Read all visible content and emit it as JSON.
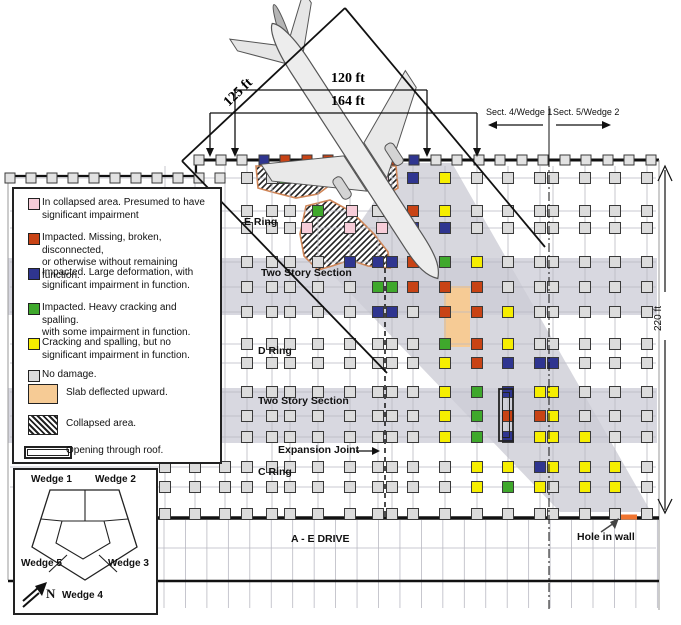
{
  "diagram": {
    "colors": {
      "P": "#f7cdd9",
      "R": "#c84315",
      "B": "#2f3590",
      "G": "#3fa82c",
      "Y": "#f6ee00",
      "gray": "#dcdcdc",
      "facade_gray": "#e2e2e2",
      "band": "#d8d8e0",
      "swath": "#cdcdd6",
      "slab": "#f6cb95",
      "hole_orange": "#f07430",
      "hatch_outline": "#cf8557",
      "grid_line": "#b9b9c2"
    },
    "facade": {
      "y": 160,
      "square_xs": [
        199,
        221,
        242,
        264,
        285,
        307,
        328,
        350,
        371,
        393,
        414,
        436,
        457,
        479,
        500,
        522,
        543,
        565,
        586,
        608,
        629,
        651
      ],
      "colored": {
        "3": "B",
        "4": "R",
        "5": "R",
        "6": "R",
        "9": "R",
        "10": "B"
      }
    },
    "left_wall": {
      "line_y": 176,
      "squares_y": 178,
      "xs": [
        10,
        31,
        52,
        73,
        94,
        115,
        136,
        157,
        178,
        199,
        220
      ]
    },
    "grid": {
      "cols": [
        247,
        272,
        290,
        318,
        350,
        378,
        392,
        413,
        445,
        477,
        508,
        540,
        553,
        585,
        615,
        647
      ],
      "left_cols": [
        165,
        195,
        225
      ],
      "rows": [
        178,
        211,
        228,
        262,
        287,
        312,
        344,
        363,
        392,
        416,
        437,
        467,
        487,
        514
      ]
    },
    "damage_squares": [
      {
        "x": 285,
        "y": 178,
        "c": "G"
      },
      {
        "x": 313,
        "y": 178,
        "c": "P"
      },
      {
        "x": 383,
        "y": 178,
        "c": "P"
      },
      {
        "x": 413,
        "y": 178,
        "c": "B"
      },
      {
        "x": 445,
        "y": 178,
        "c": "Y"
      },
      {
        "x": 318,
        "y": 211,
        "c": "G"
      },
      {
        "x": 352,
        "y": 211,
        "c": "P"
      },
      {
        "x": 413,
        "y": 211,
        "c": "R"
      },
      {
        "x": 445,
        "y": 211,
        "c": "Y"
      },
      {
        "x": 307,
        "y": 228,
        "c": "P"
      },
      {
        "x": 350,
        "y": 228,
        "c": "P"
      },
      {
        "x": 382,
        "y": 228,
        "c": "P"
      },
      {
        "x": 413,
        "y": 228,
        "c": "B"
      },
      {
        "x": 445,
        "y": 228,
        "c": "B"
      },
      {
        "x": 350,
        "y": 262,
        "c": "B"
      },
      {
        "x": 378,
        "y": 262,
        "c": "B"
      },
      {
        "x": 392,
        "y": 262,
        "c": "B"
      },
      {
        "x": 413,
        "y": 262,
        "c": "R"
      },
      {
        "x": 445,
        "y": 262,
        "c": "G"
      },
      {
        "x": 477,
        "y": 262,
        "c": "Y"
      },
      {
        "x": 378,
        "y": 287,
        "c": "G"
      },
      {
        "x": 392,
        "y": 287,
        "c": "G"
      },
      {
        "x": 413,
        "y": 287,
        "c": "R"
      },
      {
        "x": 445,
        "y": 287,
        "c": "R"
      },
      {
        "x": 477,
        "y": 287,
        "c": "R"
      },
      {
        "x": 378,
        "y": 312,
        "c": "B"
      },
      {
        "x": 392,
        "y": 312,
        "c": "B"
      },
      {
        "x": 445,
        "y": 312,
        "c": "R"
      },
      {
        "x": 477,
        "y": 312,
        "c": "R"
      },
      {
        "x": 508,
        "y": 312,
        "c": "Y"
      },
      {
        "x": 445,
        "y": 344,
        "c": "G"
      },
      {
        "x": 477,
        "y": 344,
        "c": "R"
      },
      {
        "x": 508,
        "y": 344,
        "c": "Y"
      },
      {
        "x": 445,
        "y": 363,
        "c": "Y"
      },
      {
        "x": 477,
        "y": 363,
        "c": "R"
      },
      {
        "x": 508,
        "y": 363,
        "c": "B"
      },
      {
        "x": 540,
        "y": 363,
        "c": "B"
      },
      {
        "x": 553,
        "y": 363,
        "c": "B"
      },
      {
        "x": 445,
        "y": 392,
        "c": "Y"
      },
      {
        "x": 477,
        "y": 392,
        "c": "G"
      },
      {
        "x": 508,
        "y": 392,
        "c": "B"
      },
      {
        "x": 540,
        "y": 392,
        "c": "Y"
      },
      {
        "x": 553,
        "y": 392,
        "c": "Y"
      },
      {
        "x": 445,
        "y": 416,
        "c": "Y"
      },
      {
        "x": 477,
        "y": 416,
        "c": "G"
      },
      {
        "x": 508,
        "y": 416,
        "c": "R"
      },
      {
        "x": 540,
        "y": 416,
        "c": "R"
      },
      {
        "x": 553,
        "y": 416,
        "c": "Y"
      },
      {
        "x": 445,
        "y": 437,
        "c": "Y"
      },
      {
        "x": 477,
        "y": 437,
        "c": "G"
      },
      {
        "x": 508,
        "y": 437,
        "c": "B"
      },
      {
        "x": 540,
        "y": 437,
        "c": "Y"
      },
      {
        "x": 553,
        "y": 437,
        "c": "Y"
      },
      {
        "x": 585,
        "y": 437,
        "c": "Y"
      },
      {
        "x": 477,
        "y": 467,
        "c": "Y"
      },
      {
        "x": 508,
        "y": 467,
        "c": "Y"
      },
      {
        "x": 540,
        "y": 467,
        "c": "B"
      },
      {
        "x": 553,
        "y": 467,
        "c": "Y"
      },
      {
        "x": 585,
        "y": 467,
        "c": "Y"
      },
      {
        "x": 615,
        "y": 467,
        "c": "Y"
      },
      {
        "x": 477,
        "y": 487,
        "c": "Y"
      },
      {
        "x": 508,
        "y": 487,
        "c": "G"
      },
      {
        "x": 540,
        "y": 487,
        "c": "Y"
      },
      {
        "x": 585,
        "y": 487,
        "c": "Y"
      },
      {
        "x": 615,
        "y": 487,
        "c": "Y"
      }
    ]
  },
  "labels": {
    "e_ring": "E Ring",
    "d_ring": "D Ring",
    "c_ring": "C Ring",
    "two_story": "Two Story Section",
    "expansion_joint": "Expansion Joint",
    "ae_drive": "A - E DRIVE",
    "hole_in_wall": "Hole in wall",
    "sect4": "Sect. 4/Wedge 1",
    "sect5": "Sect. 5/Wedge 2"
  },
  "dimensions": {
    "d125": "125 ft",
    "d120": "120 ft",
    "d164": "164 ft",
    "d220": "220 ft"
  },
  "legend": {
    "items": [
      {
        "c": "P",
        "lines": [
          "In collapsed area. Presumed to have",
          "significant impairment"
        ]
      },
      {
        "c": "R",
        "lines": [
          "Impacted. Missing, broken, disconnected,",
          "or otherwise without remaining function."
        ]
      },
      {
        "c": "B",
        "lines": [
          "Impacted. Large deformation, with",
          "significant impairment in function."
        ]
      },
      {
        "c": "G",
        "lines": [
          "Impacted. Heavy cracking and spalling.",
          "with some impairment in function."
        ]
      },
      {
        "c": "Y",
        "lines": [
          "Cracking and spalling, but no",
          "significant impairment in function."
        ]
      },
      {
        "c": "N",
        "lines": [
          "No damage."
        ]
      }
    ],
    "slab_label": "Slab deflected upward.",
    "collapsed_label": "Collapsed area.",
    "opening_label": "Opening through roof."
  },
  "wedge_inset": {
    "w1": "Wedge 1",
    "w2": "Wedge 2",
    "w3": "Wedge 3",
    "w4": "Wedge 4",
    "w5": "Wedge 5",
    "north": "N"
  }
}
